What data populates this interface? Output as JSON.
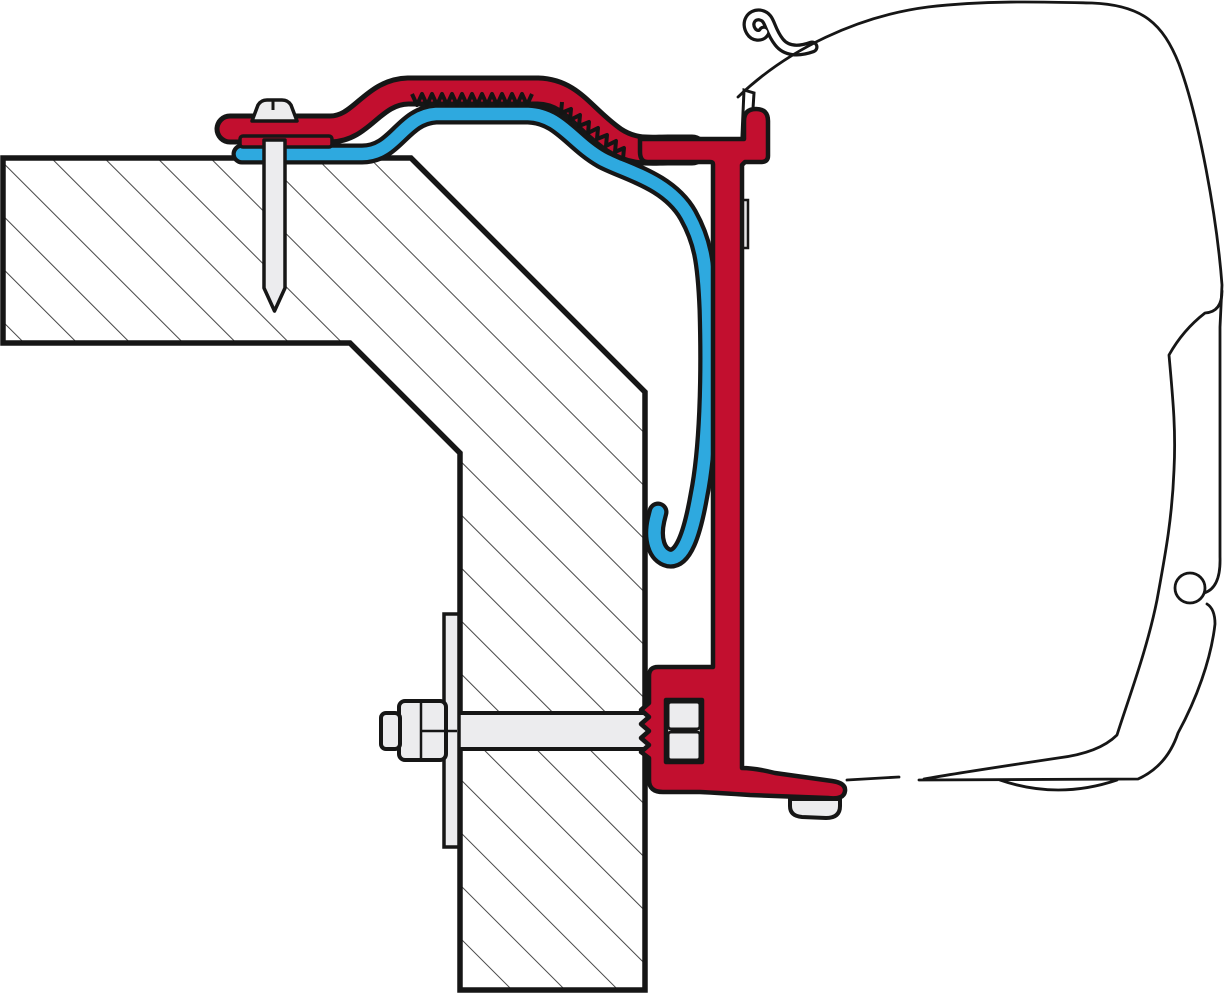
{
  "diagram": {
    "type": "technical-cross-section",
    "subject": "Awning adapter bracket wall-mounting diagram (side cross-section)",
    "colors": {
      "adapter_red": "#c20f2f",
      "rail_blue": "#2ea9df",
      "outline": "#161616",
      "metal_light": "#ececee",
      "metal_mid": "#e3e3e5",
      "background": "#ffffff",
      "hatch_line": "#2e2e2e"
    },
    "parts": [
      {
        "id": "wall",
        "label": "Vehicle wall cross-section (hatched)"
      },
      {
        "id": "adapter-bracket",
        "label": "Adapter bracket profile (red)"
      },
      {
        "id": "awning-rail",
        "label": "Awning mounting rail profile (blue)"
      },
      {
        "id": "awning-case",
        "label": "Awning case outline"
      },
      {
        "id": "top-screw",
        "label": "Upper fixing screw through wall"
      },
      {
        "id": "through-bolt",
        "label": "Through-bolt with nut and backing plate"
      },
      {
        "id": "foot-screw",
        "label": "Lower case fixing screw"
      },
      {
        "id": "clamp-spacers",
        "label": "Clamp spacer blocks"
      }
    ]
  }
}
